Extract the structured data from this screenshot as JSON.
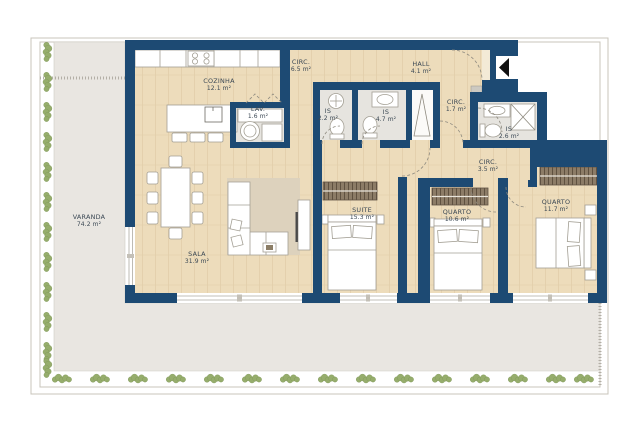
{
  "plan": {
    "rooms": [
      {
        "id": "varanda",
        "name": "VARANDA",
        "area": "74.2 m²"
      },
      {
        "id": "cozinha",
        "name": "COZINHA",
        "area": "12.1 m²"
      },
      {
        "id": "lav",
        "name": "LAV.",
        "area": "1.6 m²"
      },
      {
        "id": "circ-65",
        "name": "CIRC.",
        "area": "6.5 m²"
      },
      {
        "id": "hall",
        "name": "HALL",
        "area": "4.1 m²"
      },
      {
        "id": "is-22",
        "name": "IS",
        "area": "2.2 m²"
      },
      {
        "id": "is-47",
        "name": "IS",
        "area": "4.7 m²"
      },
      {
        "id": "circ-17",
        "name": "CIRC.",
        "area": "1.7 m²"
      },
      {
        "id": "is-26",
        "name": "IS",
        "area": "2.6 m²"
      },
      {
        "id": "circ-35",
        "name": "CIRC.",
        "area": "3.5 m²"
      },
      {
        "id": "suite",
        "name": "SUITE",
        "area": "15.3 m²"
      },
      {
        "id": "quarto-1",
        "name": "QUARTO",
        "area": "10.6 m²"
      },
      {
        "id": "quarto-2",
        "name": "QUARTO",
        "area": "11.7 m²"
      },
      {
        "id": "sala",
        "name": "SALA",
        "area": "31.9 m²"
      }
    ],
    "colors": {
      "wall": "#1d4a73",
      "wood": "#eddcbb",
      "bathroom_floor": "#e6e4df",
      "terrace": "#e9e6e1",
      "rug": "#ddd2bd",
      "wardrobe": "#8c7c67",
      "plant": "#96ad6c",
      "arrow": "#111111"
    }
  }
}
